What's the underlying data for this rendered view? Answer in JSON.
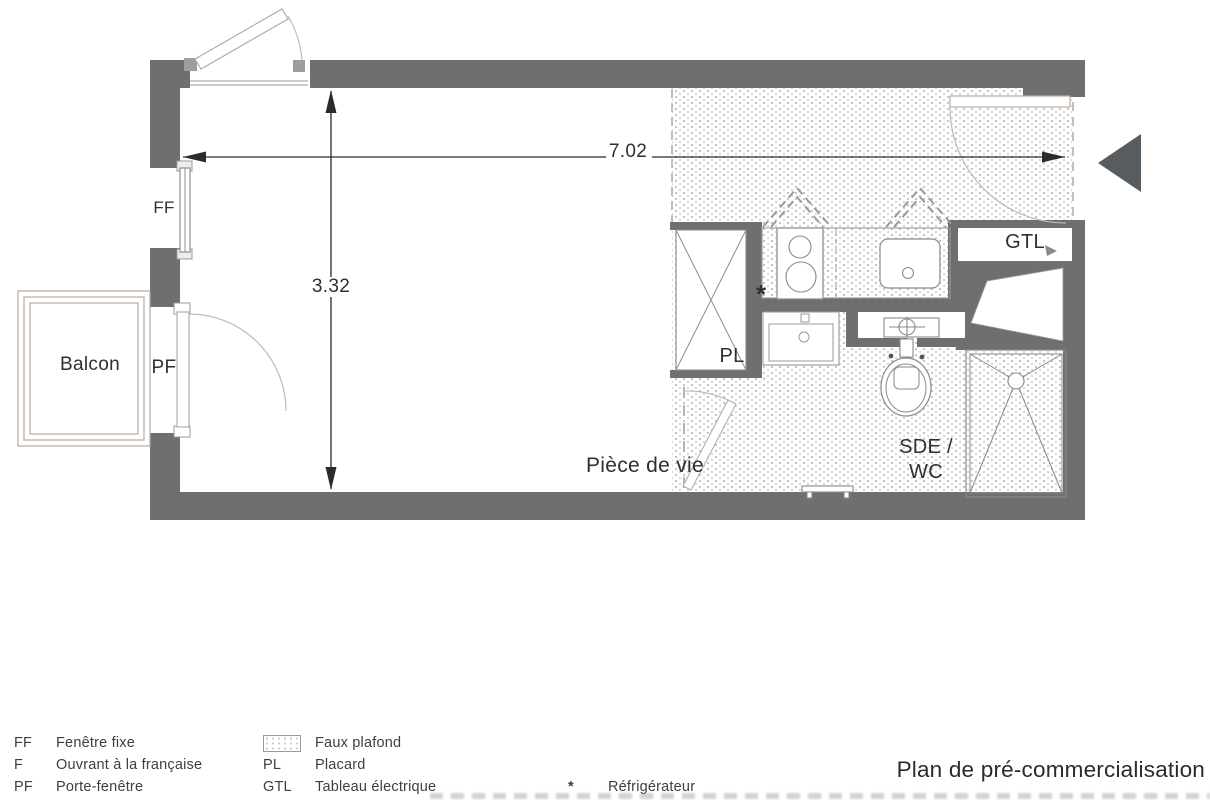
{
  "title": "Plan de pré-commercialisation",
  "plan": {
    "labels": {
      "balcon": "Balcon",
      "piece_de_vie": "Pièce de vie",
      "ff": "FF",
      "pf": "PF",
      "pl": "PL",
      "gtl": "GTL",
      "sde_wc_line1": "SDE /",
      "sde_wc_line2": "WC",
      "fridge_marker": "*"
    },
    "dimensions": {
      "width_m": "7.02",
      "height_m": "3.32"
    }
  },
  "legend": {
    "col1": [
      {
        "code": "FF",
        "label": "Fenêtre fixe"
      },
      {
        "code": "F",
        "label": "Ouvrant à la française"
      },
      {
        "code": "PF",
        "label": "Porte-fenêtre"
      }
    ],
    "col2": [
      {
        "code": "",
        "label": "Faux plafond"
      },
      {
        "code": "PL",
        "label": "Placard"
      },
      {
        "code": "GTL",
        "label": "Tableau électrique"
      }
    ],
    "col3": [
      {
        "code": "*",
        "label": "Réfrigérateur"
      }
    ]
  },
  "colors": {
    "wall": "#6f6f6f",
    "entry_arrow": "#575c60",
    "text": "#2f2f2f",
    "fixture_line": "#8f8f8f",
    "door_arc": "#c4b9b0",
    "dots": "#c4c4c4"
  }
}
